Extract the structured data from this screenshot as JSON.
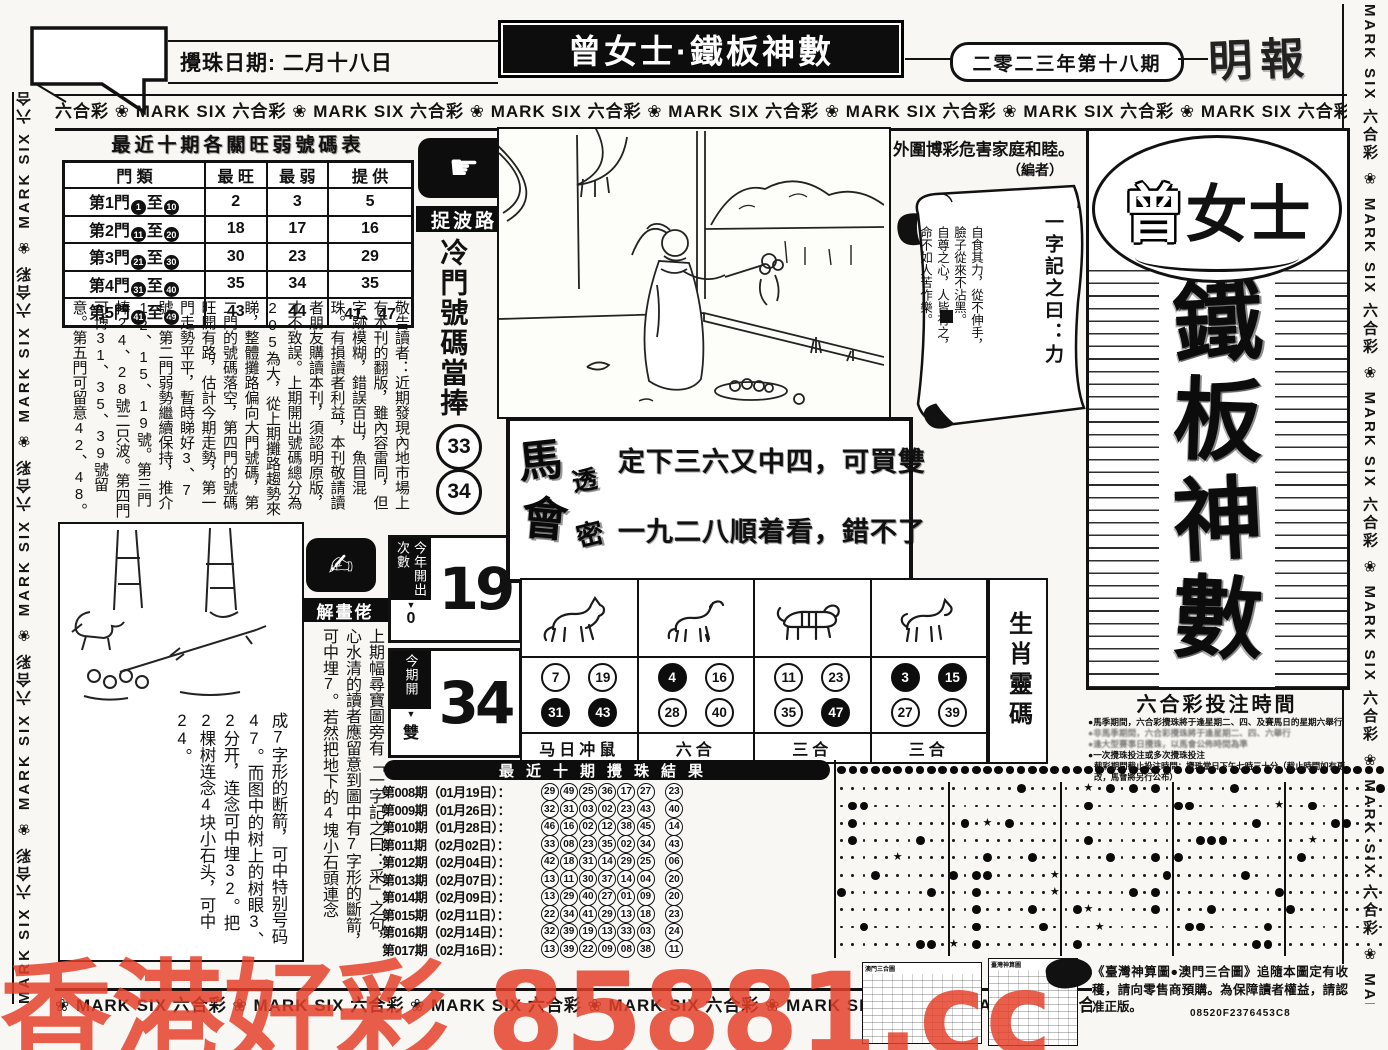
{
  "masthead": {
    "draw_date": "攪珠日期: 二月十八日",
    "title": "曾女士·鐵板神數",
    "issue": "二零二三年第十八期",
    "newspaper": "明報",
    "top_band_unit": "六合彩 ❀ MARK SIX ",
    "bottom_band_unit": "❀ MARK SIX 六合彩 ",
    "side_band_unit": "MARK SIX 六合彩 ❀ "
  },
  "hot_cold_table": {
    "title": "最近十期各關旺弱號碼表",
    "headers": [
      "門 類",
      "最 旺",
      "最 弱",
      "提 供"
    ],
    "rows": [
      {
        "gate": "第1門",
        "from": "1",
        "to": "10",
        "hot": "2",
        "weak": "3",
        "offer": "5"
      },
      {
        "gate": "第2門",
        "from": "11",
        "to": "20",
        "hot": "18",
        "weak": "17",
        "offer": "16"
      },
      {
        "gate": "第3門",
        "from": "21",
        "to": "30",
        "hot": "30",
        "weak": "23",
        "offer": "29"
      },
      {
        "gate": "第4門",
        "from": "31",
        "to": "40",
        "hot": "35",
        "weak": "34",
        "offer": "35"
      },
      {
        "gate": "第5門",
        "from": "41",
        "to": "49",
        "hot": "43",
        "weak": "44",
        "offer": "41、47"
      }
    ]
  },
  "cold_pick": {
    "badge": "捉波路",
    "headline": "冷門號碼當捧",
    "balls": [
      "33",
      "34"
    ]
  },
  "notice": "敬告讀者：近期發現內地市場上有本刊的翻版，雖內容雷同，但字跡模糊，錯誤百出，魚目混珠。有損讀者利益，本刊敬請讀者朋友購讀本刊，須認明原版，才不致誤。上期開出號碼總分為205為大，從上期攤路趨勢來睇，整體攤路偏向大門號碼，第二門的號碼落空，第四門的號碼旺開有路，估計今期走勢，第一門走勢平平，暫時睇好3、7號。第二門弱勢繼續保持，推介12、15、19號。第三門捧24、28號二只波。第四門可博31、35、39號留意。第五門可留意42、48。",
  "editor_note": {
    "line1": "外圍博彩危害家庭和睦。",
    "line2": "（編者）"
  },
  "scroll": {
    "title": "一字記之曰：力",
    "lines": [
      "自食其力，從不伸手，",
      "臉子從來不沾黑。",
      "自尊之心，人皆有之，",
      "命不如人苦作樂。"
    ]
  },
  "tips_banner": {
    "stamp_top": "馬會",
    "stamp_script": "透密",
    "line1": "定下三六又中四，可買雙",
    "line2": "一九二八順着看，錯不了"
  },
  "interpreter": {
    "badge": "解畫佬",
    "story_right": "上期幅尋寶圖旁有「一字記之曰：采」之句，心水清的讀者應留意到圖中有7字形的斷箭，可中埋7。若然把地下的4塊小石頭連念",
    "story_left": "成7字形的断箭，可中特别号码47。而图中的树上的树眼3、2分开，连念可中埋32。把2棵树连念4块小石头，可中24。"
  },
  "stat_boxes": {
    "year_label": "今年開出次數",
    "year_count": "0",
    "year_number": "19",
    "period_label": "今期開",
    "period_parity": "雙",
    "period_number": "34"
  },
  "zodiac_panel": {
    "side_label": "生肖靈碼",
    "columns": [
      {
        "animal": "horse",
        "label": "马日冲鼠",
        "balls": [
          {
            "n": "7"
          },
          {
            "n": "19"
          },
          {
            "n": "31",
            "solid": true
          },
          {
            "n": "43",
            "solid": true
          }
        ]
      },
      {
        "animal": "goat",
        "label": "六合",
        "balls": [
          {
            "n": "4",
            "solid": true
          },
          {
            "n": "16"
          },
          {
            "n": "28"
          },
          {
            "n": "40"
          }
        ]
      },
      {
        "animal": "tiger",
        "label": "三合",
        "balls": [
          {
            "n": "11"
          },
          {
            "n": "23"
          },
          {
            "n": "35"
          },
          {
            "n": "47",
            "solid": true
          }
        ]
      },
      {
        "animal": "dog",
        "label": "三合",
        "balls": [
          {
            "n": "3",
            "solid": true
          },
          {
            "n": "15",
            "solid": true
          },
          {
            "n": "27"
          },
          {
            "n": "39"
          }
        ]
      }
    ]
  },
  "chart_data": {
    "type": "table",
    "title": "最近十期攪珠結果",
    "matrix_columns": 49,
    "draws": [
      {
        "issue": "第008期",
        "date": "01月19日",
        "numbers": [
          29,
          49,
          25,
          36,
          17,
          27
        ],
        "special": 23
      },
      {
        "issue": "第009期",
        "date": "01月26日",
        "numbers": [
          32,
          31,
          3,
          2,
          23,
          43
        ],
        "special": 40
      },
      {
        "issue": "第010期",
        "date": "01月28日",
        "numbers": [
          46,
          16,
          2,
          12,
          38,
          45
        ],
        "special": 14
      },
      {
        "issue": "第011期",
        "date": "02月02日",
        "numbers": [
          33,
          8,
          23,
          35,
          2,
          34
        ],
        "special": 43
      },
      {
        "issue": "第012期",
        "date": "02月04日",
        "numbers": [
          42,
          18,
          31,
          14,
          29,
          25
        ],
        "special": 6
      },
      {
        "issue": "第013期",
        "date": "02月07日",
        "numbers": [
          13,
          11,
          30,
          37,
          14,
          4
        ],
        "special": 20
      },
      {
        "issue": "第014期",
        "date": "02月09日",
        "numbers": [
          13,
          29,
          40,
          27,
          1,
          9
        ],
        "special": 20
      },
      {
        "issue": "第015期",
        "date": "02月11日",
        "numbers": [
          22,
          34,
          41,
          29,
          13,
          18
        ],
        "special": 23
      },
      {
        "issue": "第016期",
        "date": "02月14日",
        "numbers": [
          32,
          39,
          19,
          13,
          33,
          3
        ],
        "special": 24
      },
      {
        "issue": "第017期",
        "date": "02月16日",
        "numbers": [
          13,
          39,
          22,
          9,
          8,
          38
        ],
        "special": 11
      }
    ]
  },
  "right_panel": {
    "brand": "曾女士",
    "calligraphy": "鐵板神數"
  },
  "betting_info": {
    "title": "六合彩投注時間",
    "bullets": [
      {
        "text": "馬季期間，六合彩攪珠將于逢星期二、四、及賽馬日的星期六舉行",
        "legible": true
      },
      {
        "text": "非馬季期間，六合彩攪珠將于逢星期二、四、六舉行",
        "legible": false
      },
      {
        "text": "逢大型賽事日攪珠，以馬會公佈時間為準",
        "legible": false
      },
      {
        "text": "一次攪珠投注或多次攪珠投注",
        "legible": true
      }
    ],
    "deadline": "截彩期間截止投注時間：攪珠當日下午七時三十分（截止時間如有更改，馬會將另行公布）"
  },
  "footer": {
    "thumb1_caption": "澳門三合圖",
    "thumb2_caption": "臺灣神算圖",
    "promo": "《臺灣神算圖●澳門三合圖》追隨本圖定有收穫，請向零售商預購。為保障讀者權益，請認准正版。",
    "code": "08520F2376453C8"
  },
  "watermark": "香港好彩 85881.cc"
}
